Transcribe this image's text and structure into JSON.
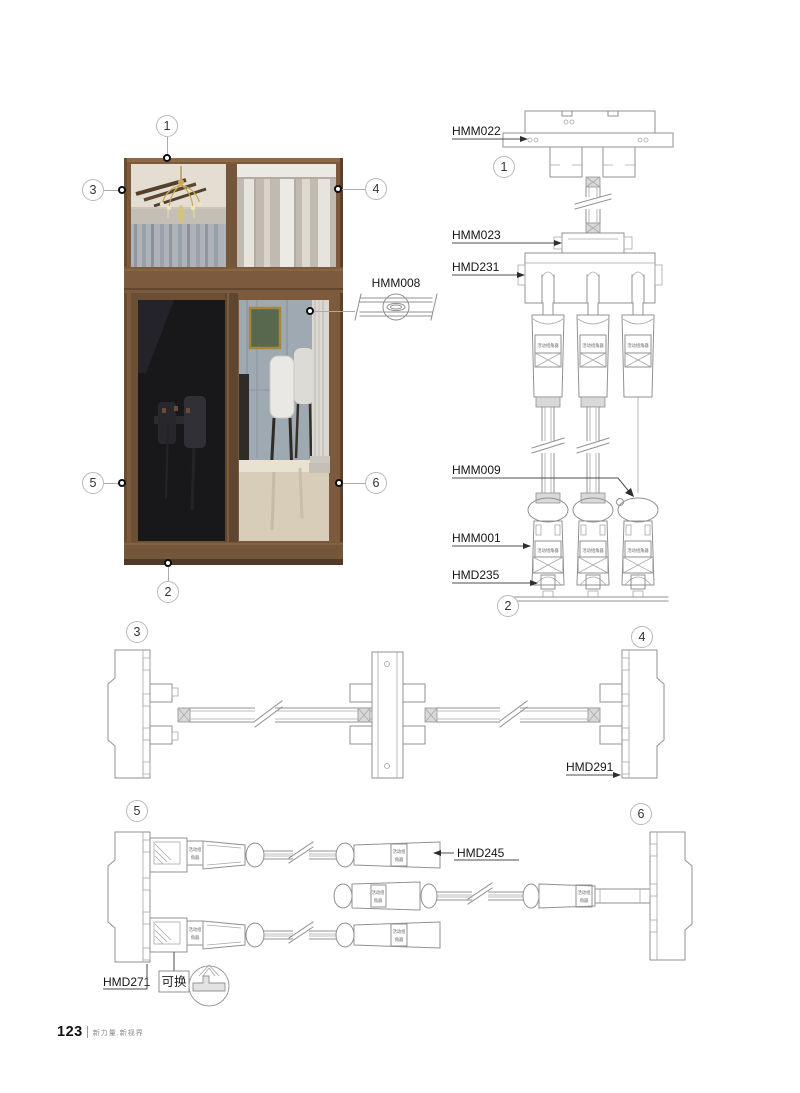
{
  "page": {
    "number": "123",
    "slogan": "新力量.新视界"
  },
  "callouts": {
    "c1": "1",
    "c2": "2",
    "c3": "3",
    "c4": "4",
    "c5": "5",
    "c6": "6"
  },
  "labels": {
    "hmm022": "HMM022",
    "hmm023": "HMM023",
    "hmd231": "HMD231",
    "hmm009": "HMM009",
    "hmm001": "HMM001",
    "hmd235": "HMD235",
    "hmm008": "HMM008",
    "hmd291": "HMD291",
    "hmd245": "HMD245",
    "hmd271": "HMD271",
    "replaceable": "可换",
    "part_tag": "活动组角器",
    "part_tag_line1": "活动组",
    "part_tag_line2": "角器"
  },
  "colors": {
    "frame_brown": "#7b5a3d",
    "drawing_line_gray": "#919191",
    "label_black": "#161616"
  }
}
